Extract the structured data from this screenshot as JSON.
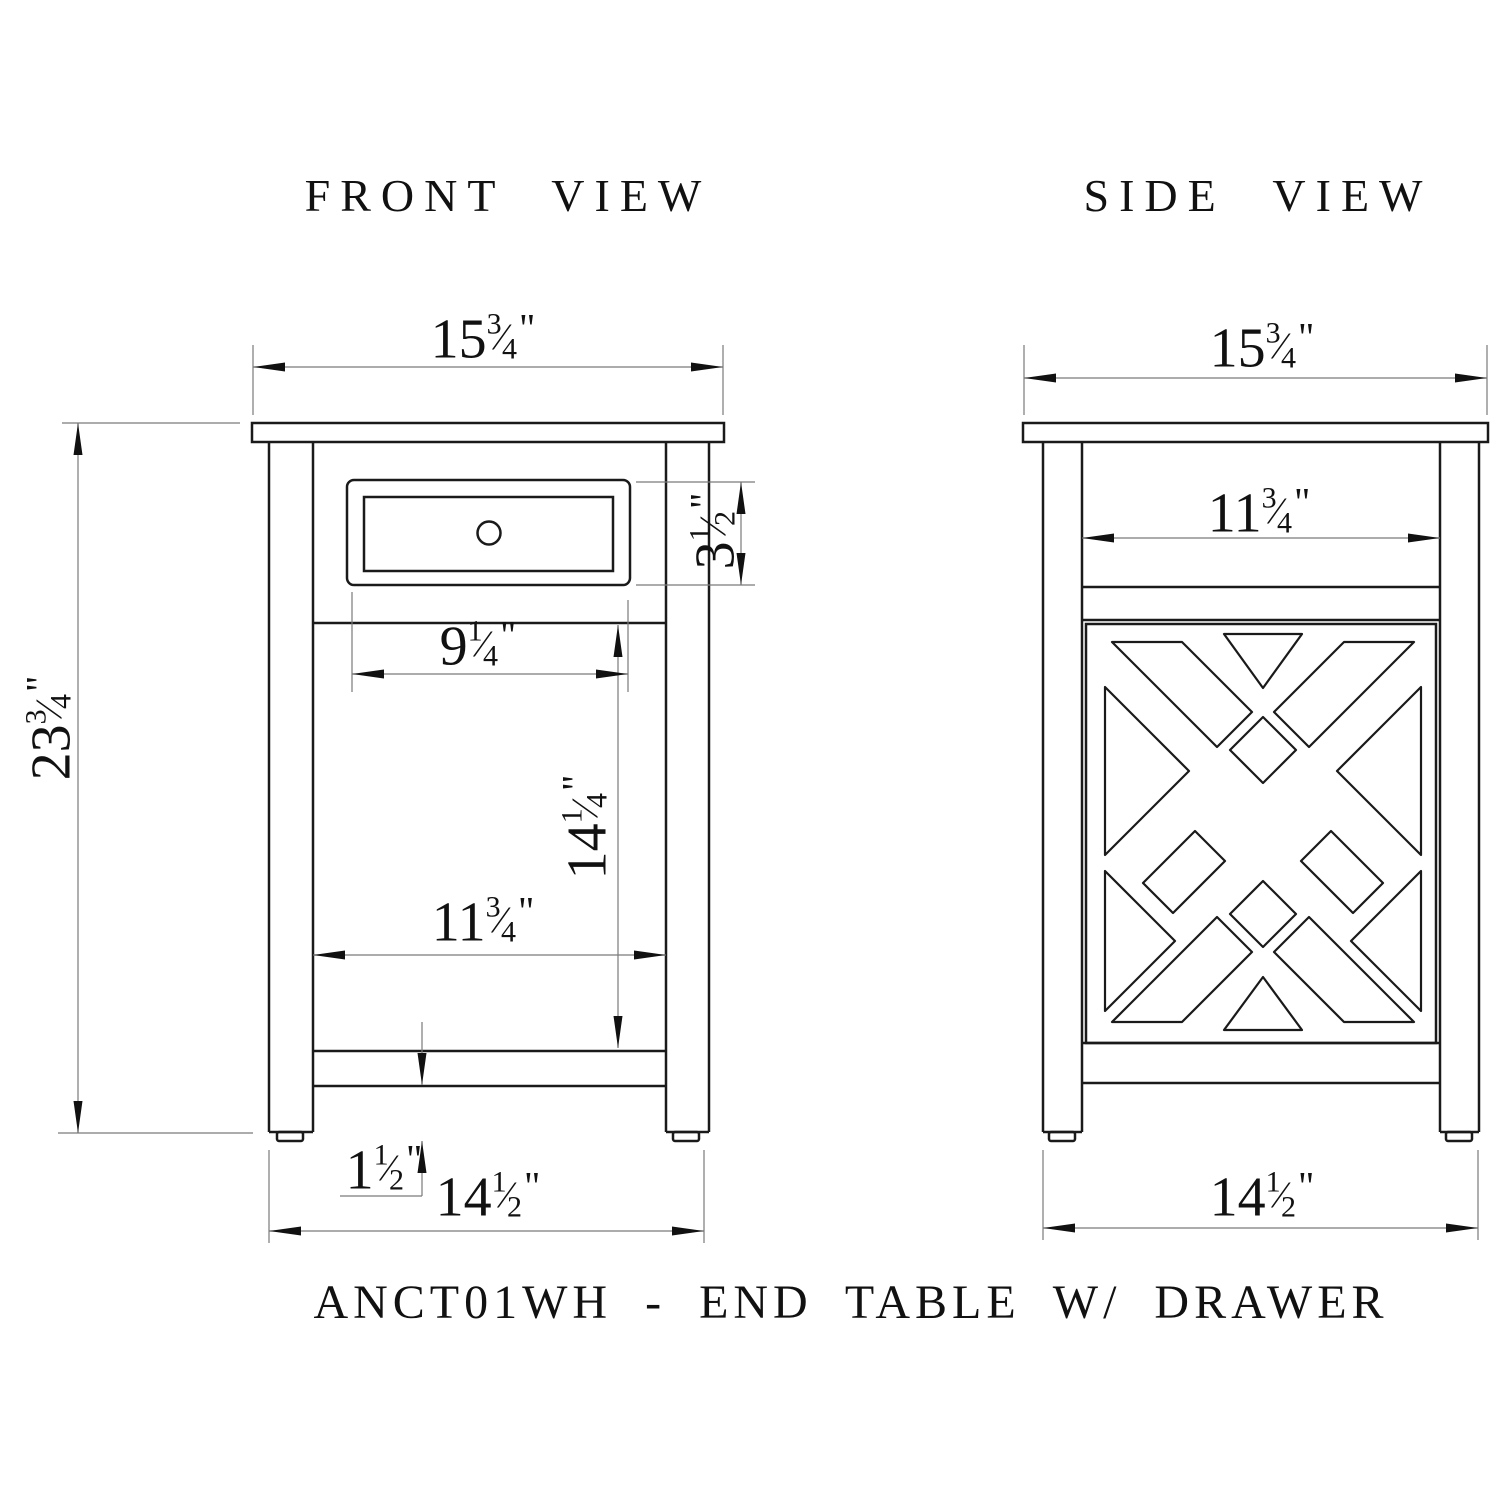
{
  "front_view": {
    "title": "FRONT VIEW",
    "dimensions": {
      "top_width": {
        "whole": "15",
        "num": "3",
        "den": "4",
        "unit": "\""
      },
      "height": {
        "whole": "23",
        "num": "3",
        "den": "4",
        "unit": "\""
      },
      "drawer_height": {
        "whole": "3",
        "num": "1",
        "den": "2",
        "unit": "\""
      },
      "drawer_width": {
        "whole": "9",
        "num": "1",
        "den": "4",
        "unit": "\""
      },
      "interior_height": {
        "whole": "14",
        "num": "1",
        "den": "4",
        "unit": "\""
      },
      "interior_width": {
        "whole": "11",
        "num": "3",
        "den": "4",
        "unit": "\""
      },
      "shelf_height": {
        "whole": "1",
        "num": "1",
        "den": "2",
        "unit": "\""
      },
      "base_width": {
        "whole": "14",
        "num": "1",
        "den": "2",
        "unit": "\""
      }
    }
  },
  "side_view": {
    "title": "SIDE VIEW",
    "dimensions": {
      "top_depth": {
        "whole": "15",
        "num": "3",
        "den": "4",
        "unit": "\""
      },
      "interior_depth": {
        "whole": "11",
        "num": "3",
        "den": "4",
        "unit": "\""
      },
      "base_depth": {
        "whole": "14",
        "num": "1",
        "den": "2",
        "unit": "\""
      }
    }
  },
  "caption": "ANCT01WH - END TABLE W/ DRAWER",
  "fraction_slash": "⁄",
  "colors": {
    "line": "#1a1a1a",
    "dim_line": "#7a7a7a",
    "arrow": "#111111",
    "background": "#ffffff"
  }
}
